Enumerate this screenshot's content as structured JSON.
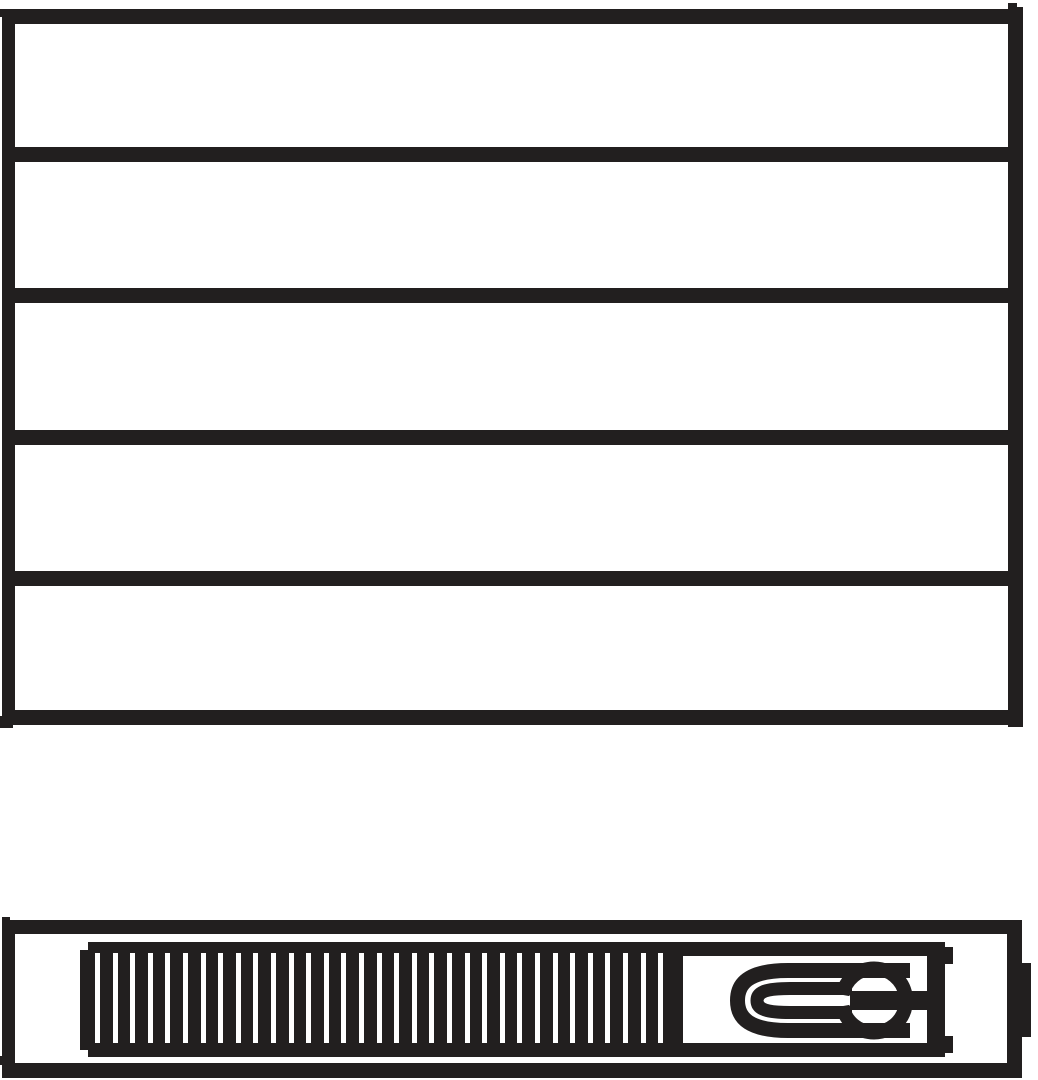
{
  "drawing": {
    "kind": "monochrome-technical-pictogram",
    "subject": "panel-radiator",
    "colors": {
      "ink": "#221f1f",
      "paper": "#ffffff"
    },
    "front_view": {
      "name": "radiator-front-view",
      "panel_count": 5,
      "divider_count": 4
    },
    "profile_view": {
      "name": "radiator-profile-view",
      "grille_slat_count": 33,
      "parts": [
        "convector-grille",
        "valve-housing",
        "u-tube-element",
        "knob"
      ]
    }
  }
}
